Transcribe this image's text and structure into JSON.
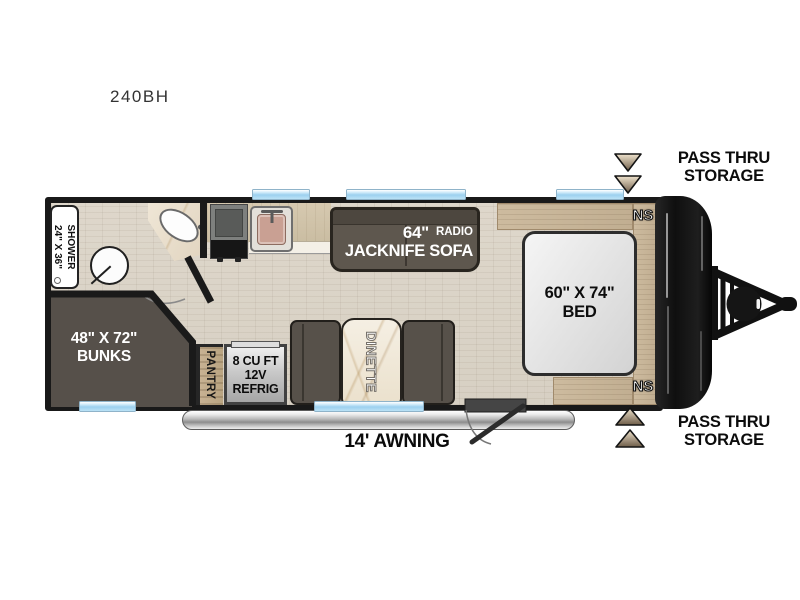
{
  "page": {
    "title": "240BH"
  },
  "exterior": {
    "brand": "SPORTSMEN",
    "storage_top": {
      "line1": "PASS THRU",
      "line2": "STORAGE"
    },
    "storage_bottom": {
      "line1": "PASS THRU",
      "line2": "STORAGE"
    },
    "awning_label": "14' AWNING"
  },
  "interior": {
    "shower": {
      "label": "SHOWER",
      "dims": "24\" X 36\""
    },
    "bunks": {
      "dims": "48\" X 72\"",
      "label": "BUNKS"
    },
    "pantry_label": "PANTRY",
    "refrigerator": {
      "line1": "8 CU FT",
      "line2": "12V",
      "line3": "REFRIG"
    },
    "dinette_label": "DINETTE",
    "sofa": {
      "size": "64\"",
      "radio": "RADIO",
      "label": "JACKNIFE SOFA"
    },
    "bed": {
      "dims": "60\" X 74\"",
      "label": "BED"
    },
    "nightstand_top": "NS",
    "nightstand_bottom": "NS"
  },
  "colors": {
    "wall": "#1a1a1a",
    "floor": "#d8d1c4",
    "furniture_dark": "#57514a",
    "wood_accent": "#c9b69a",
    "window_blue": "#9cd0ef",
    "marble": "#f2ebdd",
    "awning_steel": "#b9b9b9"
  }
}
